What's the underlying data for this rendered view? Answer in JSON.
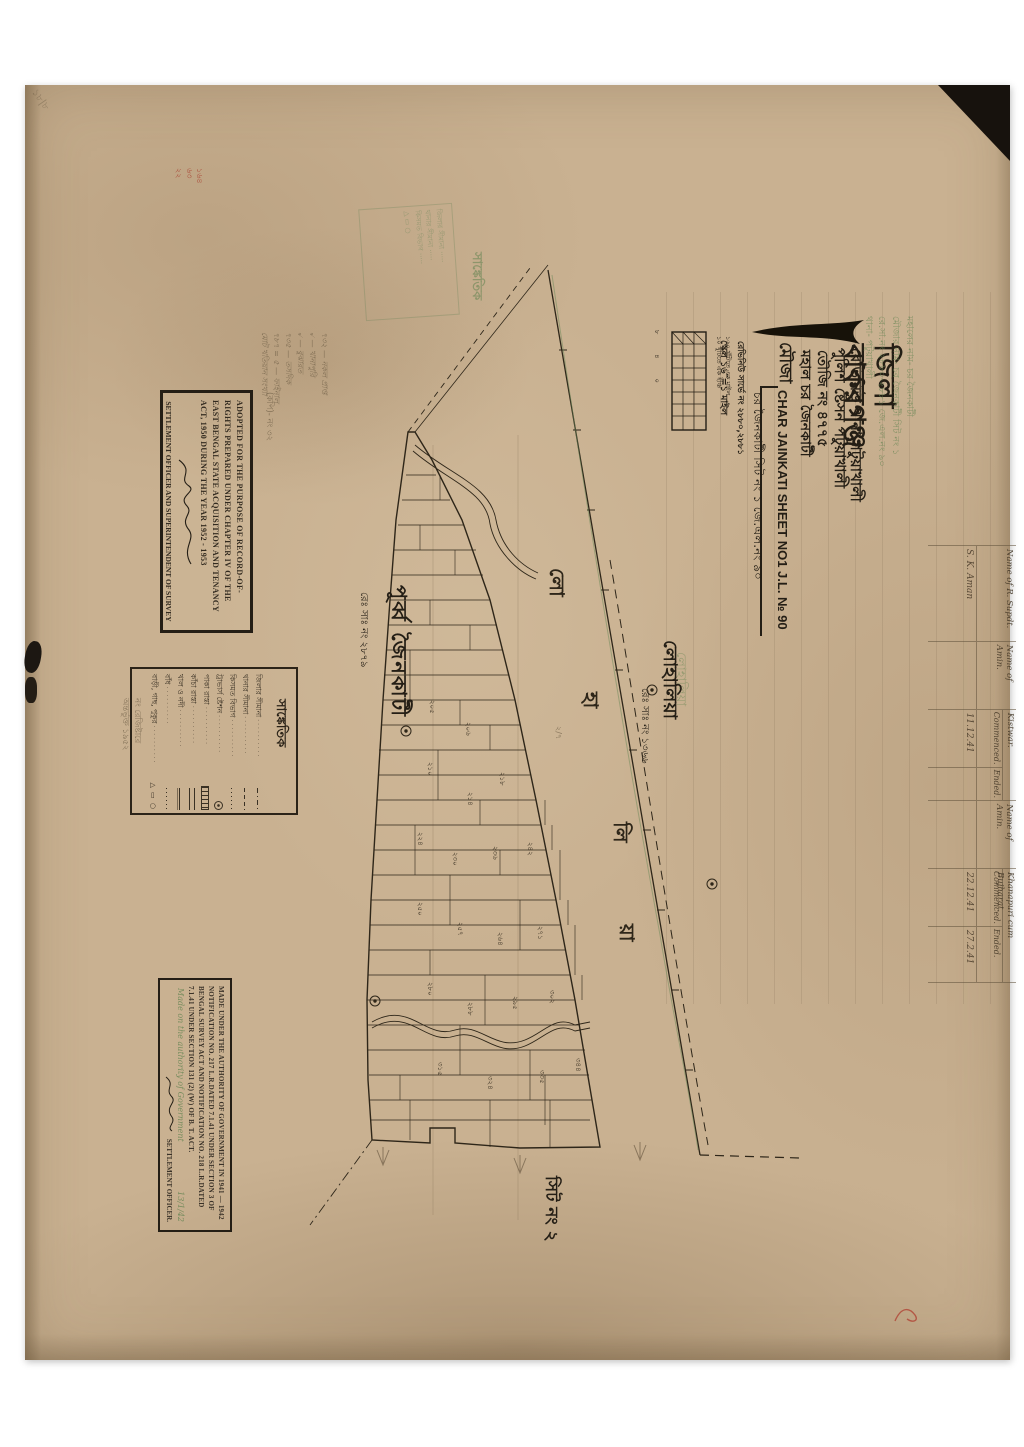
{
  "colors": {
    "paper": "#c9b191",
    "ink": "#241e15",
    "green_ink": "#6f9258",
    "red_ink": "#a83c2c",
    "pencil": "#6e5c44"
  },
  "title_block": {
    "district": "জিলা বাকরগঞ্জ",
    "revenue_thana": "রেভিনিউ থানা পটুয়াখালী",
    "police_station": "পুলিশ ষ্টেসন পটুয়াখালী",
    "touzi": "তৌজি নং ৪৭৭৫",
    "mahal": "মহাল চর জৈনকাটী",
    "mouza_label": "মৌজা",
    "sheet_title_en": "CHAR JAINKATI SHEET NO1   J.L. № 90",
    "sheet_title_bn": "চর জৈনকাটী সিট নং ১   জে.এল.নং ৯০",
    "revenue_survey": "রেভিনিউ সার্ভে নং ২৮৮০,২৮৮১",
    "scale_label": "স্কেল ১৬″=১ মাইল"
  },
  "scale_bar": {
    "ticks": "৮ ৪ ০",
    "caption1": "১৬০ খুঁটিতে এক মাইল",
    "caption2": "১০ খুঁটিতে এক ইঞ্চি"
  },
  "green_note": {
    "lines": [
      "মহালের নাম- চর জৈনকাটী",
      "মৌজার নাম- চর জৈনকাটী সিট নং ১",
      "রে.সা.নং ২৮৮০-২৮৮১  জে.এল.নং ৯০",
      "থানা- পটুয়াখালী"
    ]
  },
  "survey_table": {
    "col1_header": "Name of R. Supdt.",
    "col1_value": "S. K. Aman",
    "col2_header": "Name of Amin.",
    "col2_value": "",
    "group1_title": "Kistwar.",
    "group1_sub1": "Commenced.",
    "group1_sub2": "Ended.",
    "group1_val1": "11.12.41",
    "group1_val2": "",
    "col3_header": "Name of Amin.",
    "col3_value": "",
    "group2_title": "Khanapuri cum Bujharat.",
    "group2_sub1": "Commenced.",
    "group2_sub2": "Ended.",
    "group2_val1": "22.12.41",
    "group2_val2": "27.2.41"
  },
  "stamp_adopted": {
    "text": "ADOPTED FOR THE PURPOSE OF RECORD-OF-RIGHTS PREPARED UNDER CHAPTER IV OF THE EAST BENGAL STATE ACQUISITION AND TENANCY ACT, 1950 DURING THE YEAR 1952 - 1953",
    "footer": "SETTLEMENT OFFICER AND SUPERINTENDENT OF SURVEY"
  },
  "stamp_authority": {
    "text": "MADE UNDER THE AUTHORITY OF GOVERNMENT IN 1941 — 1942   NOTIFICATION NO. 217   L.R.DATED 7.1.41   UNDER SECTION 3 OF BENGAL SURVEY ACT AND NOTIFICATION NO. 218   L.R.DATED 7.1.41   UNDER SECTION 131 (2) (W) OF B. T. ACT.",
    "script_note": "Made on the authority of Government",
    "footer": "SETTLEMENT OFFICER.",
    "date_note": "13/1/42"
  },
  "pencil_block": {
    "lines": [
      "৭৩২ — নকল প্রাপ্ত",
      "৵ — খানাপুরি",
      "৵ — বুঝারত",
      "৭৩৫ — তসদিক",
      "৭৮৭ = ৫ — ফাইনাল",
      "মোট খতিয়ান সংখ্যা"
    ]
  },
  "margin_notes": {
    "copy_note": "(কপি)- নং ৩২",
    "register_note": [
      "নং রেজিষ্টারে",
      "অন্তর্ভুক্ত ১৯৫২"
    ],
    "red_marks": [
      "১৬৪",
      "৬৩",
      "২২"
    ],
    "corner_note": "১৮|৮",
    "map_pencil_note": "২/৭"
  },
  "legend": {
    "title": "সাঙ্কেতিক",
    "rows": [
      {
        "label": "জিলার সীমানা",
        "sym": "dashdot"
      },
      {
        "label": "থানার সীমানা",
        "sym": "dash"
      },
      {
        "label": "কিসমত বিভাগ",
        "sym": "dots"
      },
      {
        "label": "ট্রাভার্স ষ্টেশন",
        "sym": "station"
      },
      {
        "label": "পাকা রাস্তা",
        "sym": "hatch"
      },
      {
        "label": "কাঁচা রাস্তা",
        "sym": "dbar"
      },
      {
        "label": "খাল ও নদী",
        "sym": "water"
      },
      {
        "label": "বাঁধ",
        "sym": "dots"
      },
      {
        "label": "বাড়ী, গাছ, পুকুর",
        "sym": "shapes"
      }
    ],
    "shape_glyphs": "△ ▭ ○"
  },
  "map": {
    "purba": "পূর্ব্ব জৈনকাটী",
    "purba_rs": "রেঃ সাঃ নং ২৮৭৯",
    "lohalia": "লোহালিয়া",
    "lohalia_rs": "রেঃ সাঃ নং ১৩৬৬",
    "lohalia_green": "লোহালিয়া",
    "river_letters": [
      "লো",
      "হা",
      "লি",
      "য়া"
    ],
    "sheet2": "সিট নং ২",
    "plots": [
      {
        "x": 432,
        "y": 700,
        "n": "২০৫"
      },
      {
        "x": 468,
        "y": 722,
        "n": "২০৬"
      },
      {
        "x": 430,
        "y": 762,
        "n": "২১০"
      },
      {
        "x": 470,
        "y": 792,
        "n": "২১৪"
      },
      {
        "x": 502,
        "y": 772,
        "n": "২১৮"
      },
      {
        "x": 420,
        "y": 832,
        "n": "২২৪"
      },
      {
        "x": 455,
        "y": 852,
        "n": "২৩০"
      },
      {
        "x": 495,
        "y": 846,
        "n": "২৩৬"
      },
      {
        "x": 530,
        "y": 842,
        "n": "২৪২"
      },
      {
        "x": 420,
        "y": 902,
        "n": "২৫০"
      },
      {
        "x": 460,
        "y": 922,
        "n": "২৫৭"
      },
      {
        "x": 500,
        "y": 932,
        "n": "২৬৪"
      },
      {
        "x": 540,
        "y": 926,
        "n": "২৭১"
      },
      {
        "x": 430,
        "y": 982,
        "n": "২৮০"
      },
      {
        "x": 470,
        "y": 1002,
        "n": "২৮৮"
      },
      {
        "x": 515,
        "y": 996,
        "n": "২৯৫"
      },
      {
        "x": 552,
        "y": 990,
        "n": "৩০২"
      },
      {
        "x": 440,
        "y": 1062,
        "n": "৩১৫"
      },
      {
        "x": 490,
        "y": 1076,
        "n": "৩২৪"
      },
      {
        "x": 542,
        "y": 1070,
        "n": "৩৩৫"
      },
      {
        "x": 578,
        "y": 1058,
        "n": "৩৪৪"
      }
    ]
  }
}
